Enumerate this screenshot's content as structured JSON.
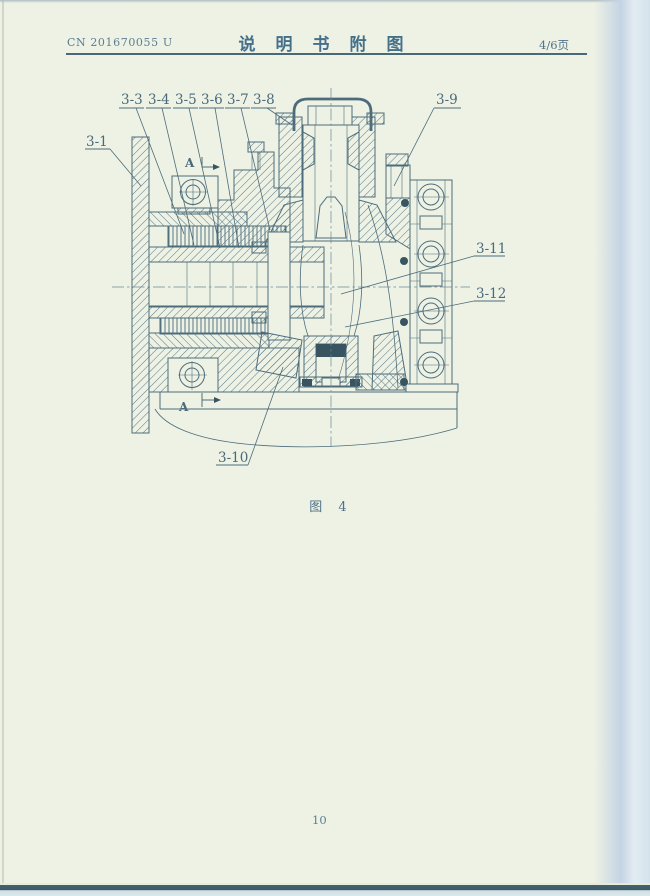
{
  "document": {
    "header": {
      "patent_number": "CN 201670055 U",
      "title": "说明书附图",
      "page_indicator": "4/6页"
    },
    "figure": {
      "caption": "图 4",
      "section_marker_top": "A",
      "section_marker_bottom": "A",
      "callouts": [
        {
          "label": "3-1"
        },
        {
          "label": "3-3"
        },
        {
          "label": "3-4"
        },
        {
          "label": "3-5"
        },
        {
          "label": "3-6"
        },
        {
          "label": "3-7"
        },
        {
          "label": "3-8"
        },
        {
          "label": "3-9"
        },
        {
          "label": "3-10"
        },
        {
          "label": "3-11"
        },
        {
          "label": "3-12"
        }
      ]
    },
    "footer": {
      "page_number": "10"
    }
  },
  "colors": {
    "ink": "#4d6c7b",
    "paper": "#eef2e4",
    "edge_band": "#c6d6e5",
    "bottom_edge": "#415f6b"
  }
}
